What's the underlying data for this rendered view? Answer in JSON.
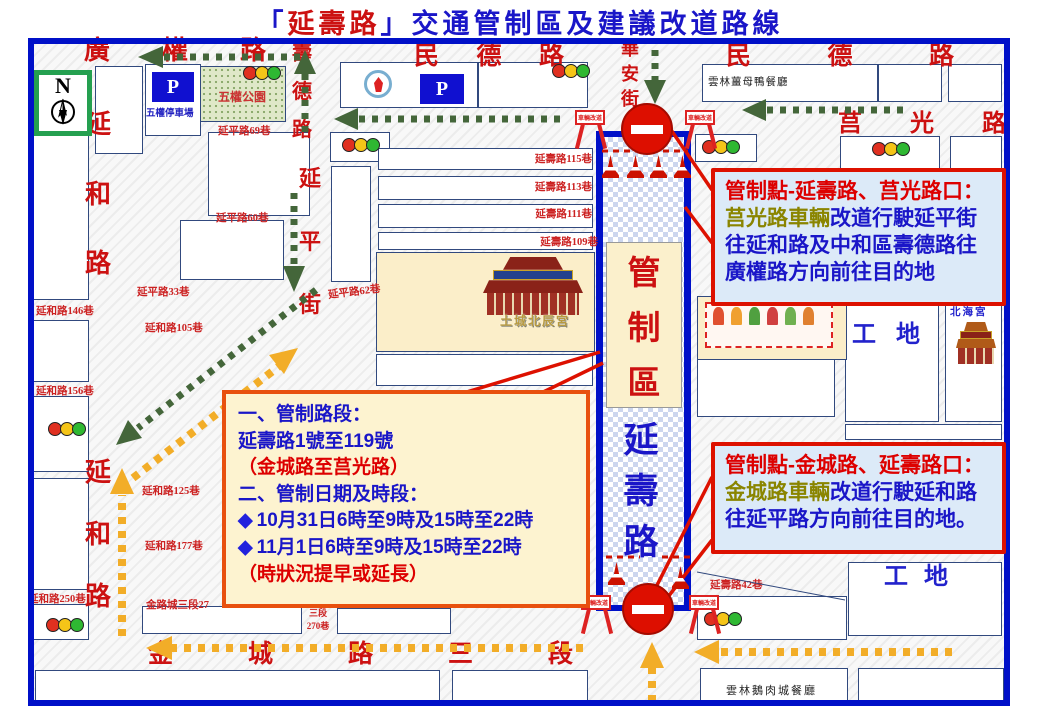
{
  "title": {
    "pre": "「",
    "road": "延壽路",
    "post": "」交通管制區及建議改道路線"
  },
  "compass": {
    "label": "N"
  },
  "roads": {
    "guangquan": "廣權路",
    "minde_left": "民德路",
    "minde_right": "民德路",
    "shoude": "壽德路",
    "huaan": "華安街",
    "juguang": "莒光路",
    "yanhe_upper": "延和路",
    "yanhe_lower": "延和路",
    "yanping_street": "延平街",
    "jincheng": "金城路三段"
  },
  "lanes": [
    "延平路69巷",
    "延平路60巷",
    "延平路33巷",
    "延平路62巷",
    "延壽路115巷",
    "延壽路113巷",
    "延壽路111巷",
    "延壽路109巷",
    "延和路146巷",
    "延和路105巷",
    "延和路156巷",
    "延和路125巷",
    "延和路177巷",
    "延和路250巷",
    "金路城三段27",
    "延壽路42巷"
  ],
  "jincheng_lane_stack": {
    "line1": "三段",
    "line2": "270巷"
  },
  "places": {
    "wuquan_park": "五權公園",
    "wuquan_parking": "五權停車場",
    "parking_symbol": "P",
    "ginger_duck": "雲林薑母鴨餐廳",
    "goose_restaurant": "雲林鵝肉城餐廳",
    "beichen_temple": "土城北辰宮",
    "beihai_temple": "北海宮",
    "construction_site_upper": "工地",
    "construction_site_lower": "工地"
  },
  "control_zone": {
    "zone_label": "管制區",
    "road_label": "延壽路"
  },
  "barricade_sign": "車輛改道",
  "info_box": {
    "line1": "一、管制路段：",
    "line2": "延壽路1號至119號",
    "line3": "（金城路至莒光路）",
    "line4": "二、管制日期及時段：",
    "bullet": "◆",
    "line5": "10月31日6時至9時及15時至22時",
    "line6": "11月1日6時至9時及15時至22時",
    "line7": "（時狀況提早或延長）"
  },
  "callout_top": {
    "title": "管制點-延壽路、莒光路口：",
    "subject": "莒光路車輛",
    "body1": "改道行駛延平街",
    "body2": "往延和路及中和區壽德路往",
    "body3": "廣權路方向前往目的地"
  },
  "callout_bottom": {
    "title": "管制點-金城路、延壽路口：",
    "subject": "金城路車輛",
    "body1": "改道行駛延和路",
    "body2": "往延平路方向前往目的地。"
  },
  "colors": {
    "map_border": "#0010c8",
    "road_text": "#cc1111",
    "blue_text": "#1a16c8",
    "olive_text": "#8a8500",
    "callout_border": "#dd1100",
    "callout_bg": "#dceaf8",
    "info_bg": "#fdf3d0",
    "info_border": "#e8500e",
    "green_route": "#44663a",
    "yellow_route": "#f2ad28"
  }
}
